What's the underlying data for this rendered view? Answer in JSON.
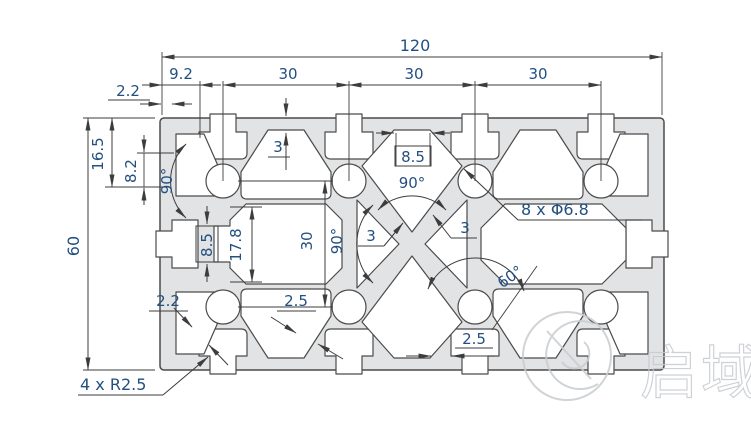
{
  "dims": {
    "total_width": "120",
    "pitch_a": "30",
    "pitch_b": "30",
    "pitch_c": "30",
    "edge_to_first_slot": "9.2",
    "top_wall": "2.2",
    "face_wall": "3",
    "total_height": "60",
    "side_groove_span": "16.5",
    "side_groove_mouth": "8.2",
    "slot_angle_left": "90°",
    "slot_mouth_top": "8.5",
    "slot_angle_top": "90°",
    "x_angle_side": "90°",
    "x_wall_a": "3",
    "x_wall_b": "3",
    "holes_callout": "8 x Φ6.8",
    "rib_angle": "60°",
    "inner_groove_mouth": "8.5",
    "inner_groove_depth": "17.8",
    "hole_row_spacing": "30",
    "bottom_wall": "2.2",
    "diag_wall": "2.5",
    "bottom_web": "2.5",
    "corner_fillet": "4 x R2.5"
  },
  "watermark": {
    "text": "启域"
  },
  "colors": {
    "profile_fill": "#e2e3e4",
    "outline": "#4b4b4b",
    "dimension_line": "#3d3d3d",
    "dimension_text": "#235081",
    "watermark": "#c8cdd1"
  }
}
